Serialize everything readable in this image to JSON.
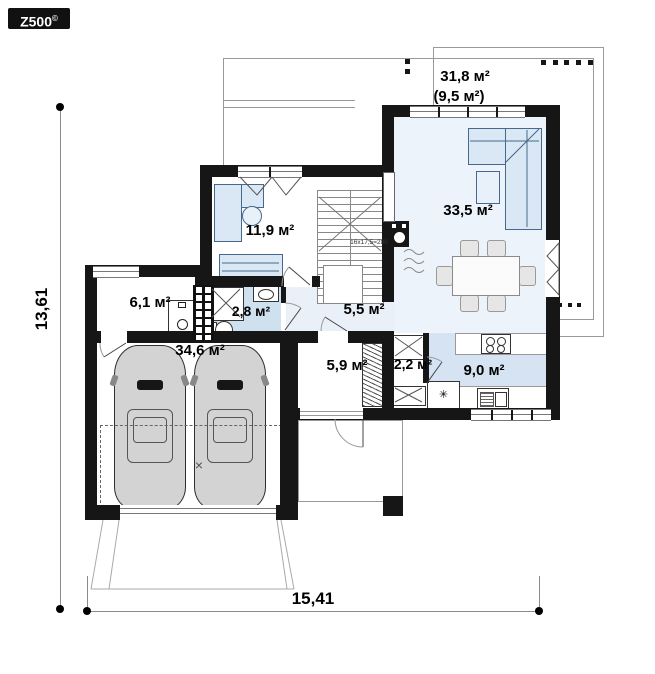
{
  "logo": {
    "text": "Z500",
    "copyright": "©"
  },
  "dimensions": {
    "width": "15,41",
    "height": "13,61"
  },
  "rooms": {
    "terrace": {
      "area": "31,8 м²",
      "area_secondary": "(9,5 м²)"
    },
    "living": {
      "area": "33,5 м²"
    },
    "cabinet": {
      "area": "11,9 м²"
    },
    "vestibule": {
      "area": "6,1 м²"
    },
    "bathroom": {
      "area": "2,8 м²"
    },
    "hall": {
      "area": "5,5 м²"
    },
    "garage": {
      "area": "34,6 м²"
    },
    "tambour": {
      "area": "5,9 м²"
    },
    "pantry": {
      "area": "2,2 м²"
    },
    "kitchen": {
      "area": "9,0 м²"
    }
  },
  "stairs": {
    "label": "16x17,5=280"
  },
  "symbols": {
    "fridge": "✳",
    "garage_cross": "×"
  },
  "colors": {
    "wall": "#161616",
    "floor_blue": "#d5e3f2",
    "floor_light": "#edf3fa",
    "furniture_fill": "#d9e8f4",
    "furniture_line": "#47688c"
  }
}
